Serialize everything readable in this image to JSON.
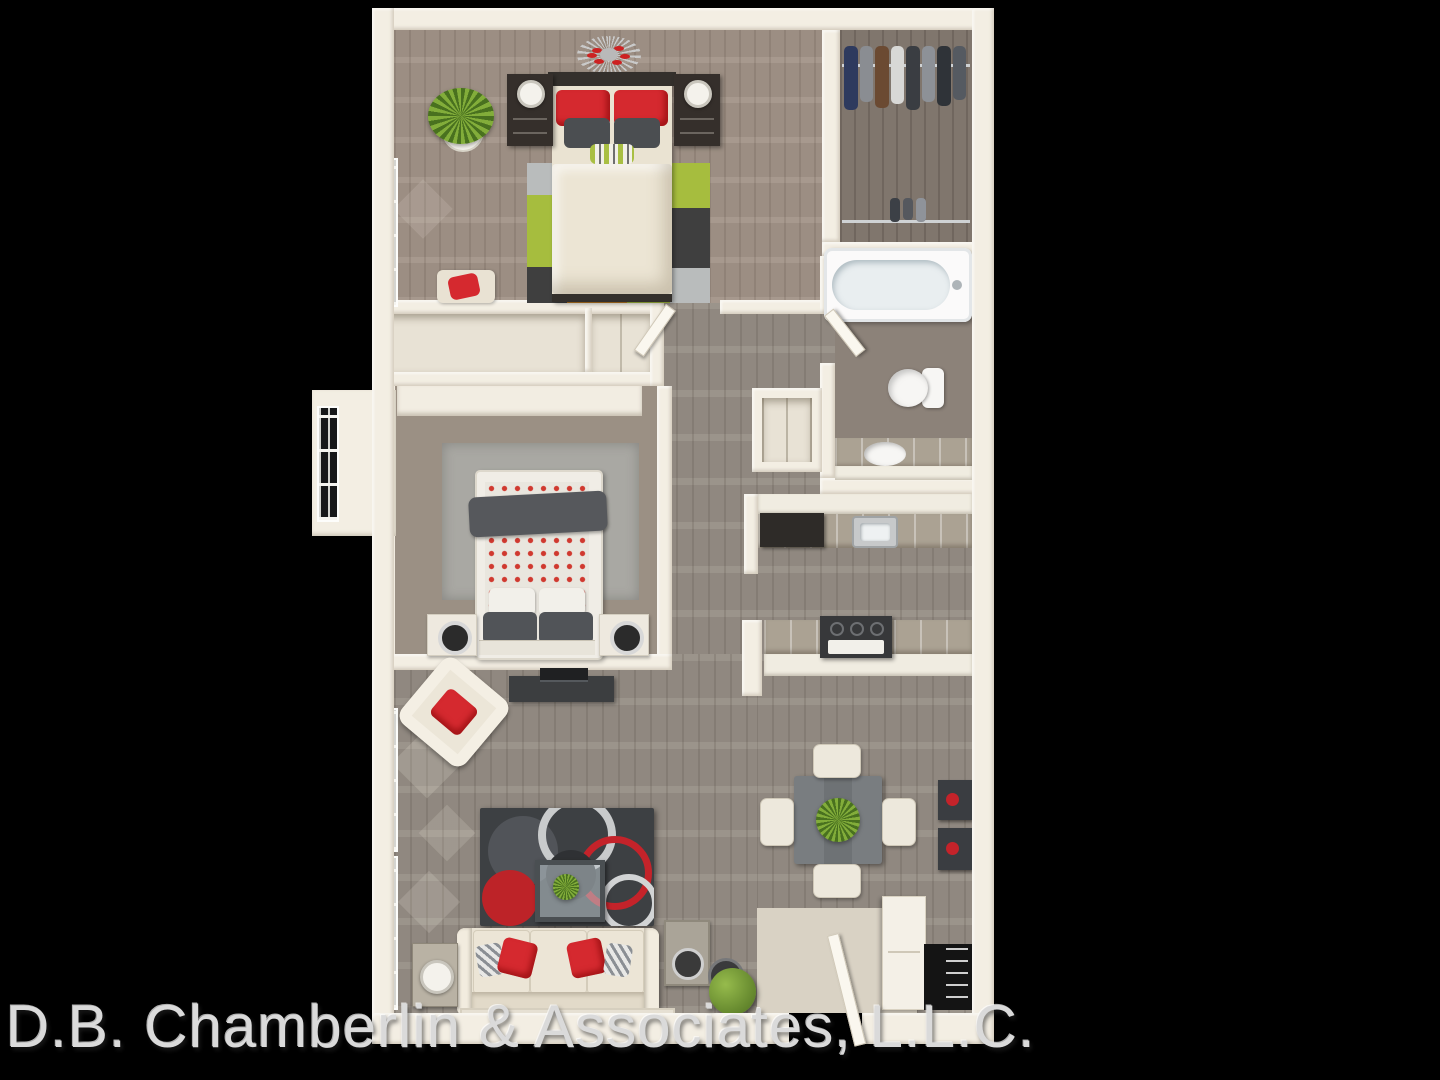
{
  "image": {
    "type": "3D apartment floor plan rendering, top-down view",
    "background_color": "#000000"
  },
  "watermark": {
    "text": "D.B. Chamberlin & Associates, L.L.C.",
    "color": "#d9d9d9"
  },
  "palette": {
    "wall": "#f1ebe0",
    "wood_warm": "#a29488",
    "wood_gray": "#968e85",
    "wood_dark_closet": "#80766d",
    "accent_red": "#d5292f",
    "accent_green": "#a6bd3e",
    "accent_orange": "#bd7a20",
    "charcoal_rug": "#3d4043",
    "cream_fabric": "#e9e2d3",
    "counter": "#aba293",
    "dark_furniture": "#34302c",
    "fixture_white": "#fbfafa"
  }
}
